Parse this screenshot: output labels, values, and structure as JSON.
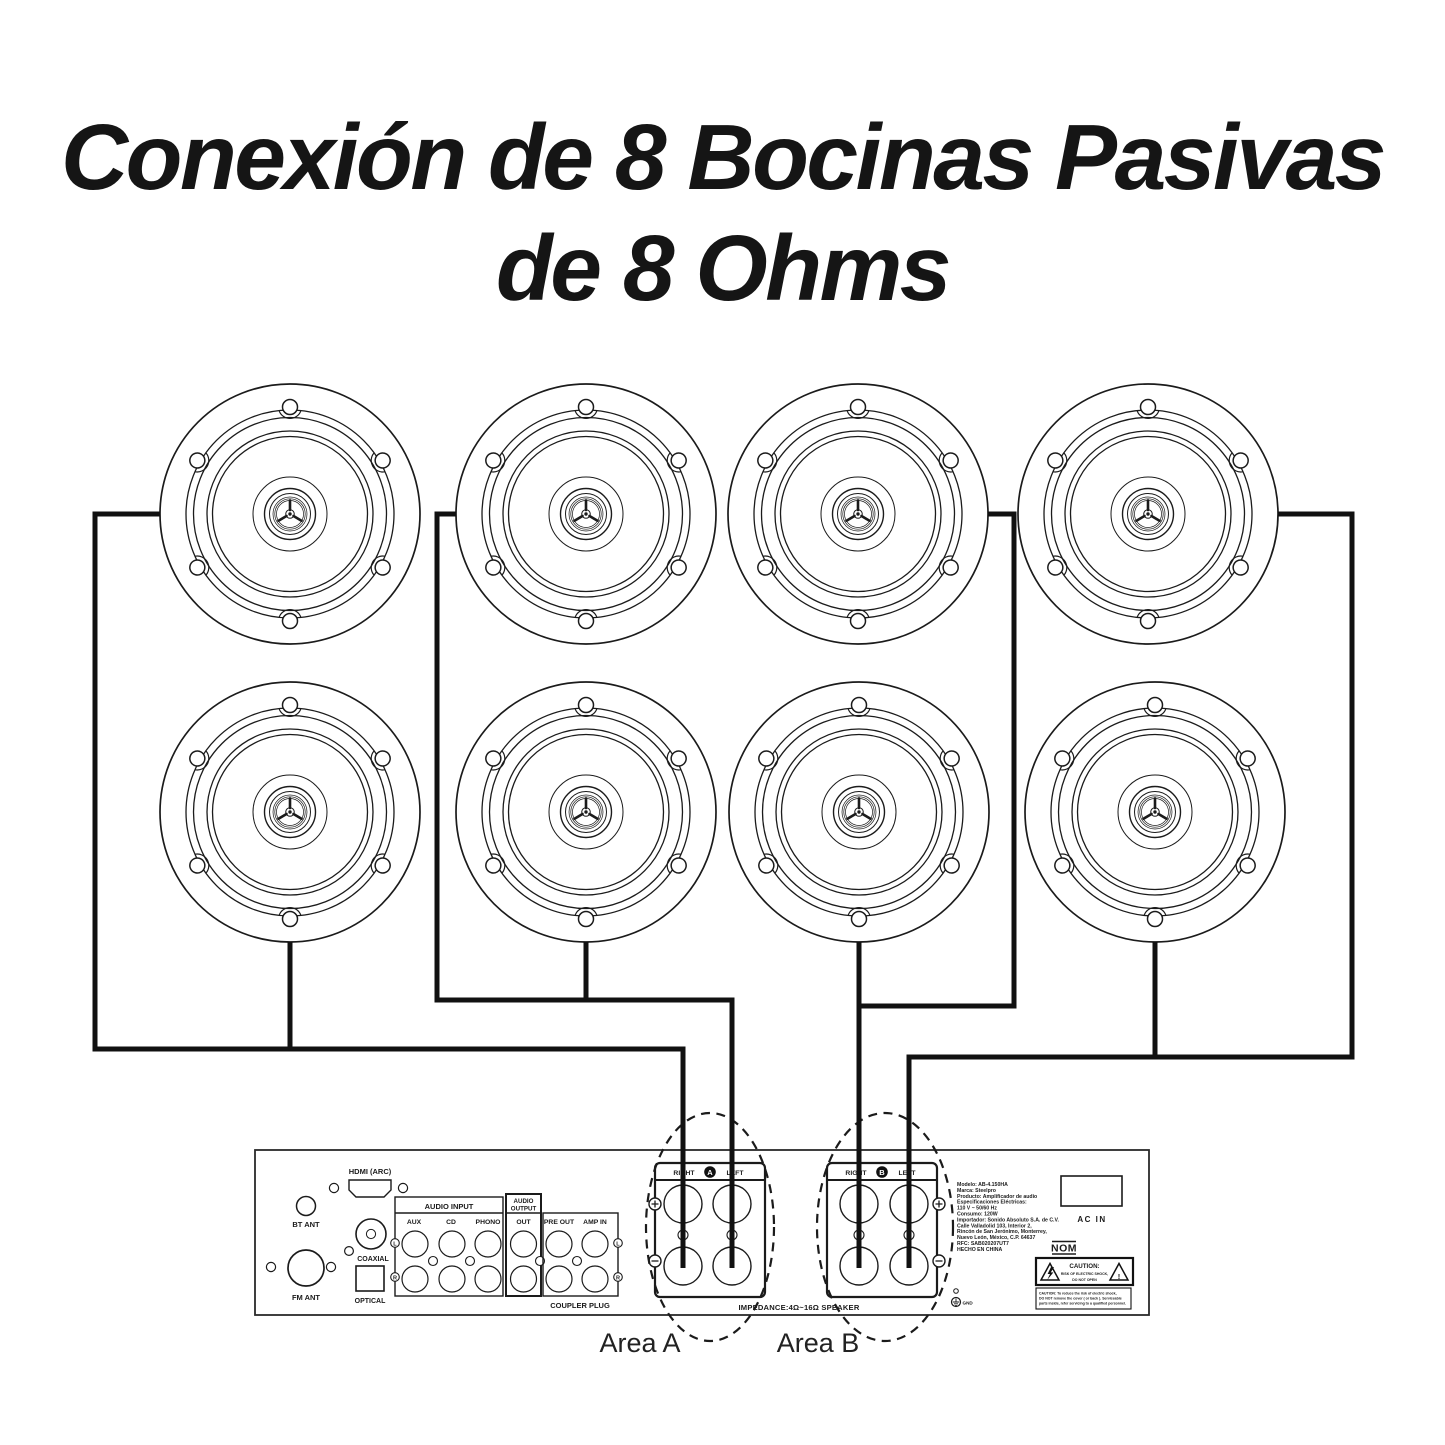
{
  "title": {
    "line1": "Conexión de 8 Bocinas Pasivas",
    "line2": "de 8 Ohms"
  },
  "zones": {
    "area_a": "Area A",
    "area_b": "Area B"
  },
  "rear_panel": {
    "hdmi_label": "HDMI (ARC)",
    "bt_ant_label": "BT ANT",
    "fm_ant_label": "FM ANT",
    "coaxial_label": "COAXIAL",
    "optical_label": "OPTICAL",
    "audio_input": {
      "header": "AUDIO INPUT",
      "jacks": [
        "AUX",
        "CD",
        "PHONO"
      ]
    },
    "audio_output": {
      "header_top": "AUDIO",
      "header_bottom": "OUTPUT",
      "jack": "OUT"
    },
    "pre_out_label": "PRE OUT",
    "amp_in_label": "AMP IN",
    "left_marker": "L",
    "right_marker": "R",
    "coupler_plug_label": "COUPLER PLUG",
    "impedance_label": "IMPEDANCE:4Ω~16Ω SPEAKER",
    "gnd_label": "GND",
    "ac_in_label": "AC IN",
    "nom_label": "NOM",
    "terminals": {
      "a": {
        "right": "RIGHT",
        "zone": "A",
        "left": "LEFT"
      },
      "b": {
        "right": "RIGHT",
        "zone": "B",
        "left": "LEFT"
      }
    },
    "product_info": [
      "Modelo: AB-4.150HA",
      "Marca: Steelpro",
      "Producto: Amplificador de audio",
      "Especificaciones Eléctricas:",
      "110 V ~ 50/60 Hz",
      "Consumo: 120W",
      "Importador: Sonido Absoluto S.A. de C.V.",
      "Calle Valladolid 103, Interior 2,",
      "Rincón de San Jerónimo, Monterrey,",
      "Nuevo León, México, C.P. 64637",
      "RFC: SAB020207UT7",
      "HECHO EN CHINA"
    ],
    "caution_badge": {
      "title": "CAUTION:",
      "line1": "RISK OF ELECTRIC SHOCK,",
      "line2": "DO NOT OPEN",
      "exclamation": "!"
    },
    "caution_note": [
      "CAUTION: To reduce the risk of electric shock,",
      "DO NOT remove the cover ( or back ). Serviceable",
      "parts inside, refer servicing to a qualified personnel."
    ]
  }
}
